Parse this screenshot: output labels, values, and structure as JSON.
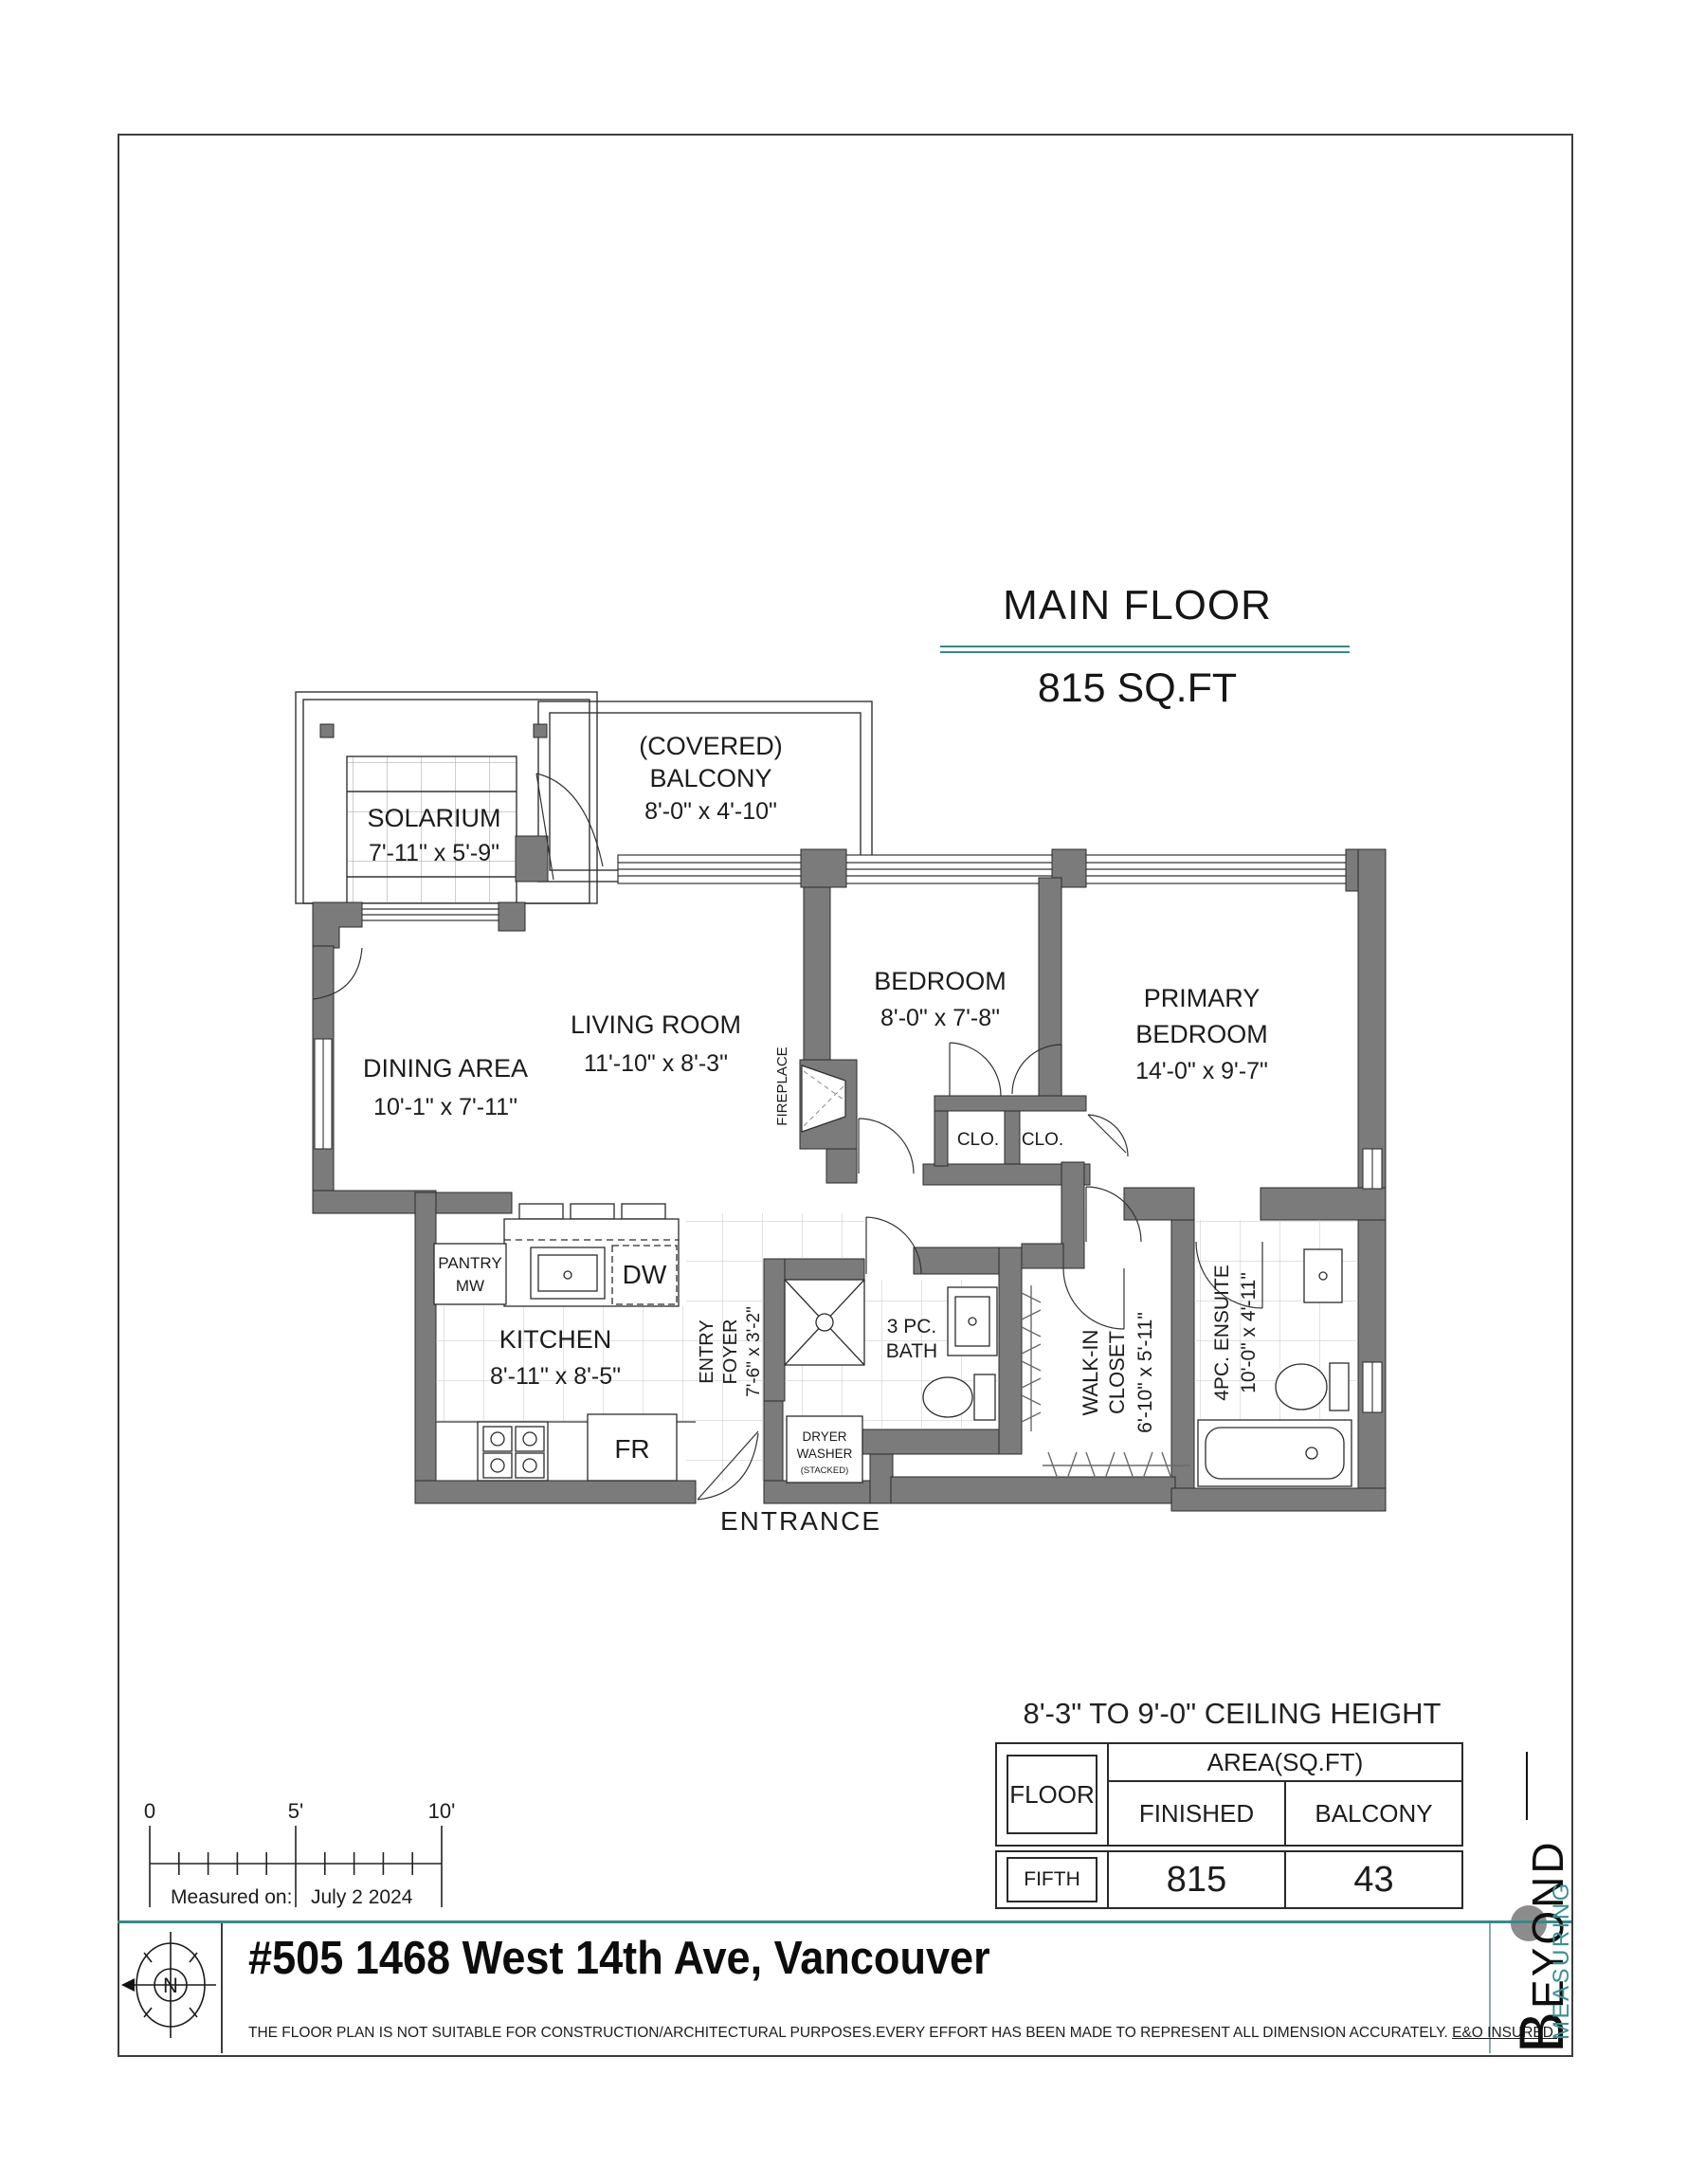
{
  "header": {
    "title": "MAIN FLOOR",
    "area": "815 SQ.FT"
  },
  "plan": {
    "solarium": {
      "name": "SOLARIUM",
      "dims": "7'-11\" x 5'-9\""
    },
    "balcony": {
      "line1": "(COVERED)",
      "line2": "BALCONY",
      "dims": "8'-0\" x 4'-10\""
    },
    "dining": {
      "name": "DINING AREA",
      "dims": "10'-1\" x 7'-11\""
    },
    "living": {
      "name": "LIVING ROOM",
      "dims": "11'-10\" x 8'-3\""
    },
    "fireplace": "FIREPLACE",
    "bedroom": {
      "name": "BEDROOM",
      "dims": "8'-0\" x 7'-8\""
    },
    "primary": {
      "line1": "PRIMARY",
      "line2": "BEDROOM",
      "dims": "14'-0\" x 9'-7\""
    },
    "closet1": "CLO.",
    "closet2": "CLO.",
    "pantry": {
      "line1": "PANTRY",
      "line2": "MW"
    },
    "dw": "DW",
    "fr": "FR",
    "kitchen": {
      "name": "KITCHEN",
      "dims": "8'-11\" x 8'-5\""
    },
    "entry": {
      "line1": "ENTRY",
      "line2": "FOYER",
      "dims": "7'-6\" x 3'-2\""
    },
    "bath": {
      "line1": "3 PC.",
      "line2": "BATH"
    },
    "laundry": {
      "line1": "DRYER",
      "line2": "WASHER",
      "line3": "(STACKED)"
    },
    "walkin": {
      "line1": "WALK-IN",
      "line2": "CLOSET",
      "dims": "6'-10\" x 5'-11\""
    },
    "ensuite": {
      "line1": "4PC. ENSUITE",
      "dims": "10'-0\" x 4'-11\""
    },
    "entrance": "ENTRANCE"
  },
  "ceiling_note": "8'-3\" TO 9'-0\" CEILING HEIGHT",
  "area_table": {
    "floor_header": "FLOOR",
    "area_header": "AREA(SQ.FT)",
    "col_finished": "FINISHED",
    "col_balcony": "BALCONY",
    "row": {
      "floor": "FIFTH",
      "finished": "815",
      "balcony": "43"
    }
  },
  "scale_bar": {
    "tick0": "0",
    "tick5": "5'",
    "tick10": "10'",
    "measured_label": "Measured on:",
    "measured_date": "July 2  2024"
  },
  "compass": {
    "north": "N"
  },
  "footer": {
    "address": "#505 1468 West 14th Ave, Vancouver",
    "disclaimer": "THE  FLOOR PLAN  IS NOT SUITABLE FOR CONSTRUCTION/ARCHITECTURAL PURPOSES.EVERY EFFORT HAS BEEN MADE TO REPRESENT ALL DIMENSION ACCURATELY. ",
    "insured": "E&O INSURED."
  },
  "logo": {
    "word1": "BEYOND",
    "word2": "MEASURING"
  },
  "colors": {
    "teal": "#348a8c",
    "wall": "#7b7b7b"
  }
}
